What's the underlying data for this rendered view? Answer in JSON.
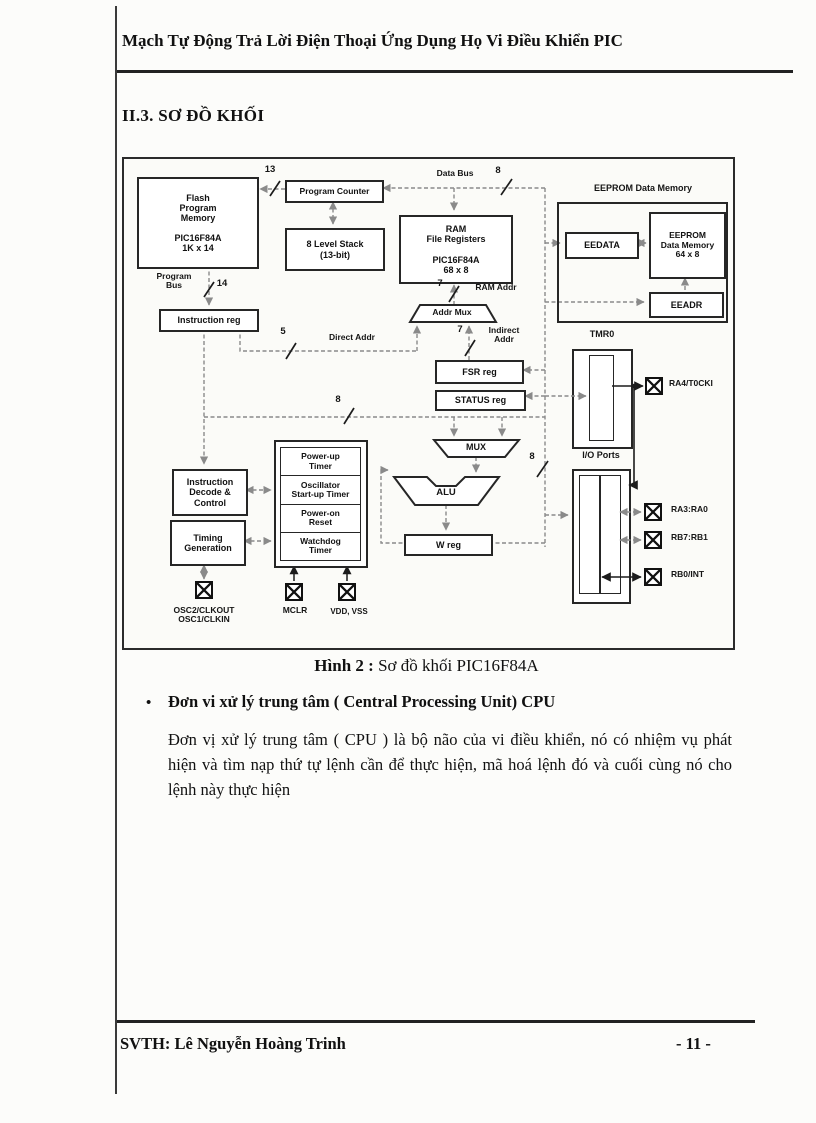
{
  "page": {
    "header": "Mạch Tự Động Trả Lời Điện Thoại Ứng Dụng Họ Vi Điều Khiển PIC",
    "section_title": "II.3. SƠ ĐỒ KHỐI",
    "caption_label": "Hình 2 :",
    "caption_text": " Sơ đồ khối PIC16F84A",
    "bullet_marker": "•",
    "bullet_heading": "Đơn vi xử lý trung tâm ( Central Processing Unit) CPU",
    "body_paragraph": "Đơn vị xử lý trung tâm ( CPU ) là bộ não của vi điều khiển, nó có nhiệm vụ phát hiện và tìm nạp thứ tự lệnh cần để thực hiện, mã hoá lệnh đó và cuối cùng nó cho lệnh này thực hiện",
    "footer_left": "SVTH: Lê Nguyễn Hoàng Trinh",
    "footer_right": "- 11 -"
  },
  "diagram": {
    "flash_memory": "Flash\nProgram\nMemory\n\nPIC16F84A\n1K x 14",
    "program_counter": "Program Counter",
    "stack": "8 Level Stack\n(13-bit)",
    "ram": "RAM\nFile Registers\n\nPIC16F84A\n68 x 8",
    "eeprom_section": "EEPROM Data Memory",
    "eedata": "EEDATA",
    "eeprom_memory": "EEPROM\nData Memory\n64 x 8",
    "eeadr": "EEADR",
    "instruction_reg": "Instruction reg",
    "addr_mux": "Addr Mux",
    "fsr_reg": "FSR reg",
    "status_reg": "STATUS reg",
    "tmr0": "TMR0",
    "mux": "MUX",
    "alu": "ALU",
    "w_reg": "W reg",
    "instruction_decode": "Instruction\nDecode &\nControl",
    "timing_generation": "Timing\nGeneration",
    "power_up_timer": "Power-up\nTimer",
    "oscillator_start_up_timer": "Oscillator\nStart-up Timer",
    "power_on_reset": "Power-on\nReset",
    "watchdog_timer": "Watchdog\nTimer",
    "io_ports": "I/O Ports",
    "buses": {
      "data_bus": "Data Bus",
      "program_bus": "Program\nBus",
      "ram_addr": "RAM Addr",
      "direct_addr": "Direct Addr",
      "indirect_addr": "Indirect\nAddr",
      "w13": "13",
      "w14": "14",
      "w8": "8",
      "w5": "5",
      "w7": "7"
    },
    "pins": {
      "osc": "OSC2/CLKOUT\nOSC1/CLKIN",
      "mclr": "MCLR",
      "vdd_vss": "VDD, VSS",
      "ra4": "RA4/T0CKI",
      "ra3": "RA3:RA0",
      "rb7": "RB7:RB1",
      "rb0": "RB0/INT"
    }
  }
}
